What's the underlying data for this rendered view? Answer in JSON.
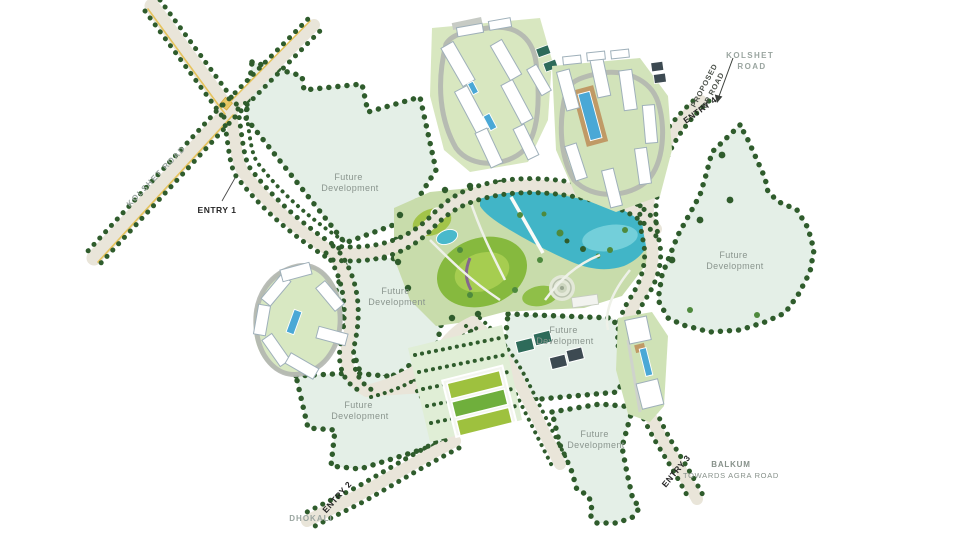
{
  "colors": {
    "zone-fill": "#e4efe7",
    "park-fill": "#c8dcab",
    "lake-fill": "#41b5c7",
    "lake-highlight": "#7cd3dd",
    "road-fill": "#e9e5d9",
    "road-edge-yellow": "#e6c35c",
    "tree-dark": "#2f5c2c",
    "tree-light": "#4e8a3d",
    "lawn-bright": "#9ec13e",
    "lawn-mid": "#86b93e",
    "building-fill": "#ffffff",
    "building-stroke": "#9fb0ba",
    "pool-blue": "#4aa8d6",
    "court-green": "#2e6b5a",
    "court-dark": "#3d4a52",
    "path-gray": "#b3b6b0",
    "label-gray": "#8a958e",
    "label-dark": "#262626",
    "road-label-gray": "#9aa5a0"
  },
  "labels": {
    "future_development": {
      "line1": "Future",
      "line2": "Development"
    },
    "roads": {
      "kolshet_left": "KOLSHET ROAD",
      "kolshet_right": {
        "line1": "KOLSHET",
        "line2": "ROAD"
      },
      "proposed_dp": {
        "line1": "PROPOSED",
        "line2": "DP ROAD"
      },
      "balkum": {
        "line1": "BALKUM",
        "line2": "TOWARDS AGRA ROAD"
      },
      "dhokali": "DHOKALI"
    },
    "entries": {
      "entry1": "ENTRY 1",
      "entry2": "ENTRY 2",
      "entry3": "ENTRY 3",
      "entry4": "ENTRY 4"
    }
  }
}
